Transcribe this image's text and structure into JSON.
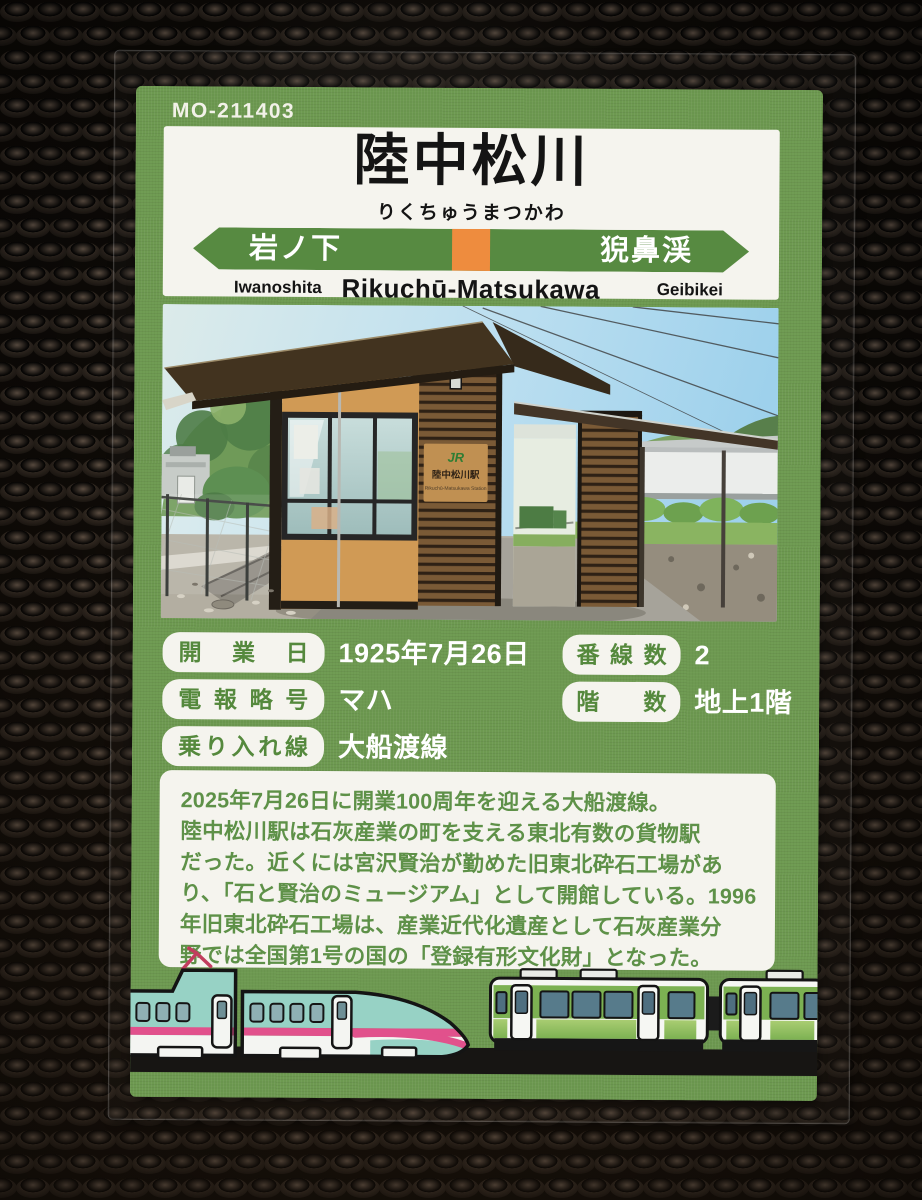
{
  "card": {
    "code": "MO-211403",
    "station_name": "陸中松川",
    "station_kana": "りくちゅうまつかわ",
    "sign": {
      "prev_name": "岩ノ下",
      "prev_romaji": "Iwanoshita",
      "center_romaji": "Rikuchū-Matsukawa",
      "next_name": "猊鼻渓",
      "next_romaji": "Geibikei"
    },
    "photo_sign": {
      "logo": "JR",
      "title": "陸中松川駅",
      "subtitle": "Rikuchū-Matsukawa Station"
    },
    "info": {
      "left": [
        {
          "label": "開業日",
          "value": "1925年7月26日"
        },
        {
          "label": "電報略号",
          "value": "マハ"
        },
        {
          "label": "乗り入れ線区",
          "value": "大船渡線"
        }
      ],
      "right": [
        {
          "label": "番線数",
          "value": "2"
        },
        {
          "label": "階数",
          "value": "地上1階"
        }
      ]
    },
    "description_lines": [
      "2025年7月26日に開業100周年を迎える大船渡線。",
      "陸中松川駅は石灰産業の町を支える東北有数の貨物駅",
      "だった。近くには宮沢賢治が勤めた旧東北砕石工場があ",
      "り、「石と賢治のミュージアム」として開館している。1996",
      "年旧東北砕石工場は、産業近代化遺産として石灰産業分",
      "野では全国第1号の国の「登録有形文化財」となった。"
    ],
    "colors": {
      "card_green": "#6d9950",
      "sign_bar_green": "#578a41",
      "accent_orange": "#ee8c3e",
      "pill_text_green": "#55893d",
      "description_text_green": "#5e9148",
      "shinkansen_teal": "#97d2c5",
      "shinkansen_stripe_pink": "#e1518c",
      "local_train_green": "#7cb152"
    }
  }
}
